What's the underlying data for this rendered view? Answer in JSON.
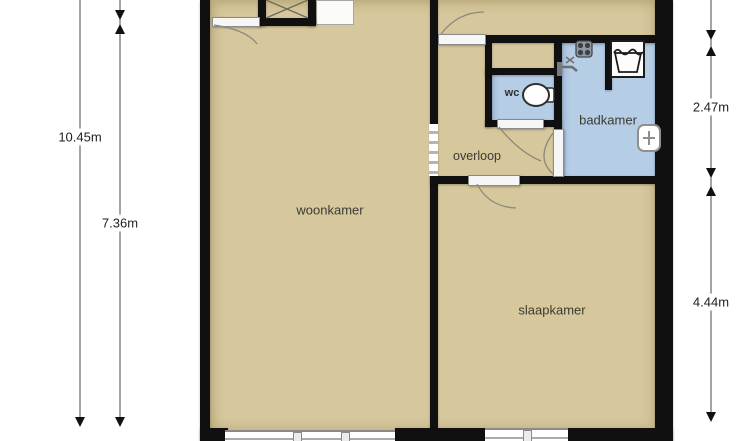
{
  "plan": {
    "rooms": {
      "woonkamer": "woonkamer",
      "slaapkamer": "slaapkamer",
      "badkamer": "badkamer",
      "overloop": "overloop",
      "wc": "wc"
    },
    "dimensions": {
      "left_total": "10.45m",
      "left_living": "7.36m",
      "right_bathroom": "2.47m",
      "right_bedroom": "4.44m"
    },
    "icons": {
      "toilet": "toilet-icon",
      "washing_machine": "washing-machine-icon",
      "ventilation": "ventilation-fan-icon",
      "shower_tap": "shower-tap-icon",
      "radiator": "radiator-icon",
      "closet_cross": "closet-cross-icon"
    },
    "colors": {
      "floor": "#d6c79c",
      "wet_floor": "#b6cde6",
      "wall": "#101010",
      "background": "#ffffff"
    }
  }
}
